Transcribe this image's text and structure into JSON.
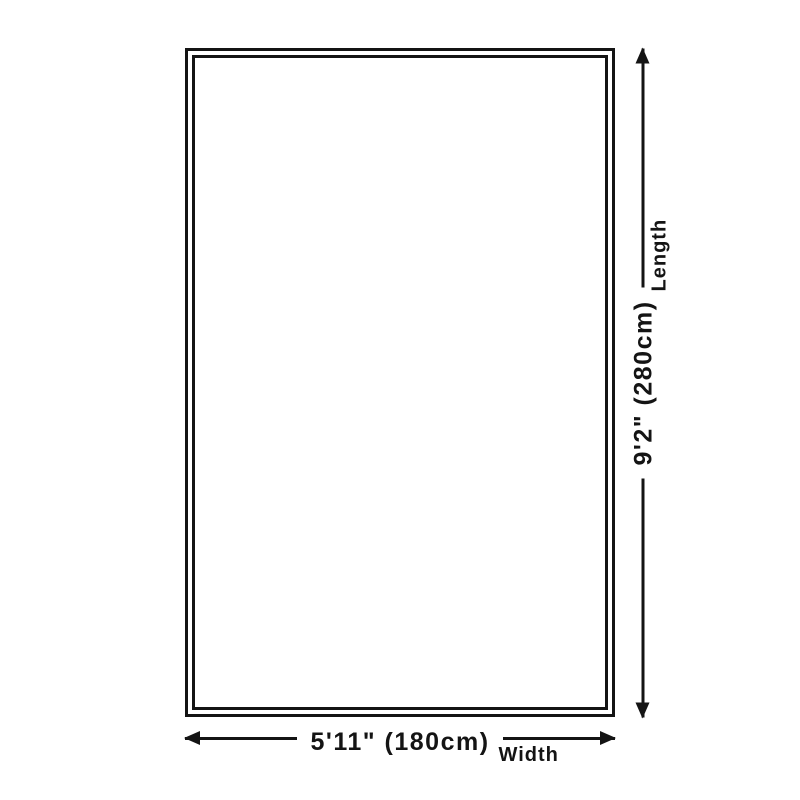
{
  "page": {
    "background": "#ffffff",
    "line_color": "#141414"
  },
  "diagram": {
    "shape": "rug-outline-rectangle",
    "dimensions": {
      "width": {
        "value": "5'11\" (180cm)",
        "label": "Width"
      },
      "length": {
        "value": "9'2\" (280cm)",
        "label": "Length"
      }
    }
  }
}
